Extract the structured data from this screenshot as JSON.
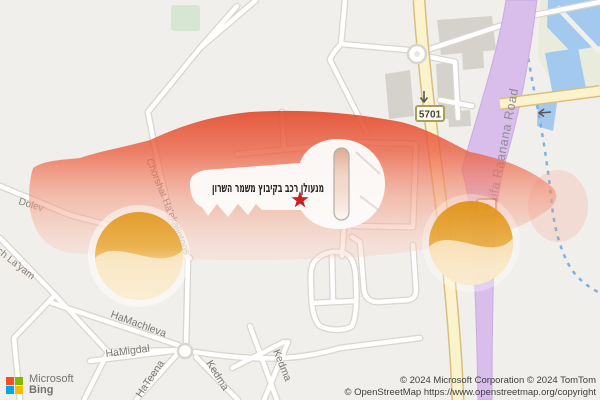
{
  "map": {
    "poi": {
      "label": "מנעולן רכב בקיבוץ משמר השרון"
    },
    "streets": {
      "dolev": "Dolev",
      "layam": "ch La'yam",
      "chorshat": "Chorshat Ha'ekaliptoos",
      "hamachleva": "HaMachleva",
      "hamigdal": "HaMigdal",
      "hateena": "HaTeena",
      "kedma1": "Kedma",
      "kedma2": "Kedma",
      "haifa_road": "Haifa Raanana Road"
    },
    "route_shields": {
      "r5701": "5701",
      "r4": "4"
    }
  },
  "branding": {
    "microsoft": "Microsoft",
    "bing": "Bing"
  },
  "attribution": {
    "line1": "© 2024 Microsoft Corporation © 2024 TomTom",
    "line2": "© OpenStreetMap https://www.openstreetmap.org/copyright"
  },
  "colors": {
    "overlay_red": "#e8502a",
    "wheel_amber": "#e8a02c",
    "star_red": "#cc1f1f",
    "water_blue": "#a4c9ef",
    "road_purple": "#d9bdeb",
    "road_yellow": "#fbf3cd"
  }
}
